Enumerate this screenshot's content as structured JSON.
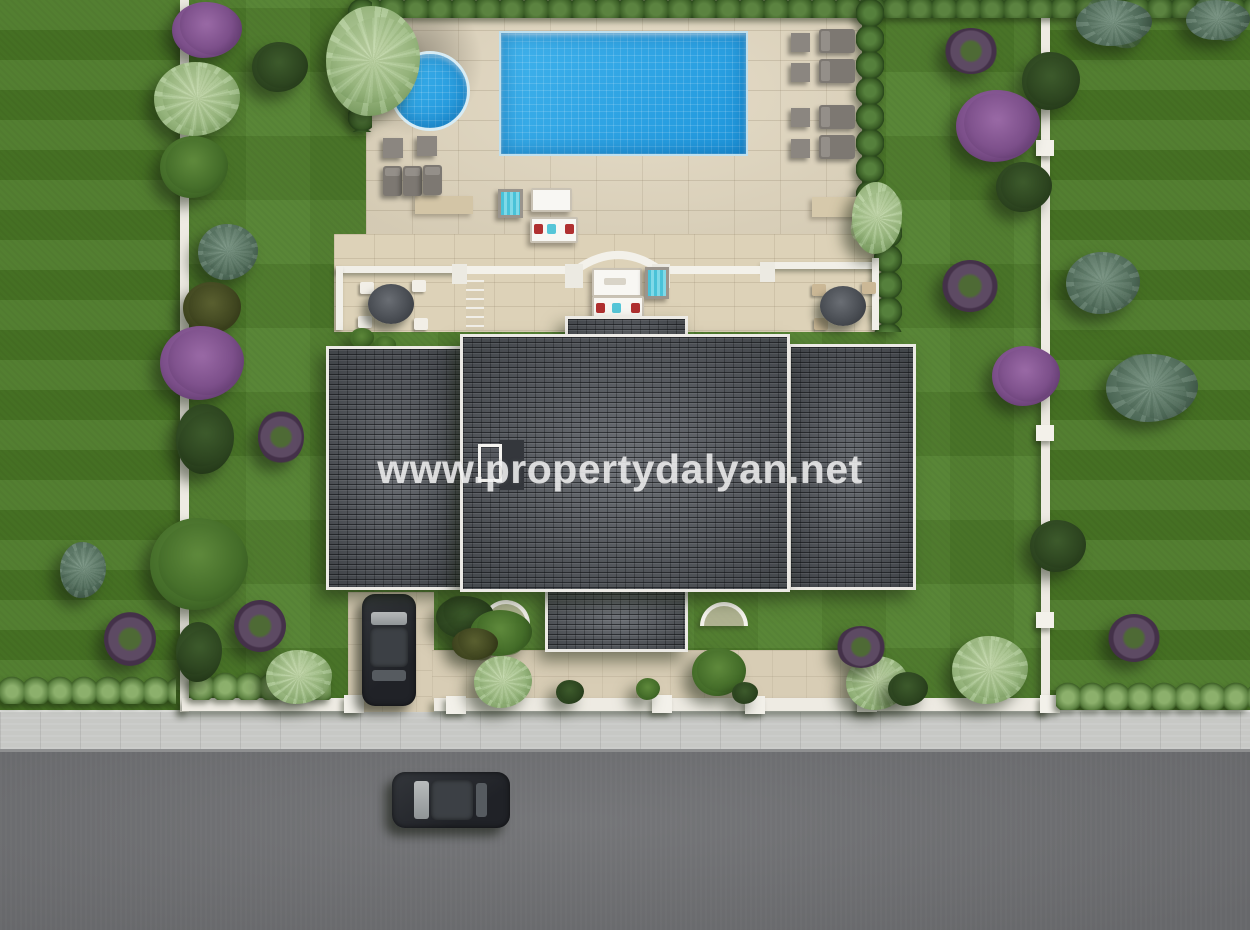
{
  "watermark": {
    "text": "www.propertydalyan.net"
  },
  "scene": {
    "type": "aerial-top-down-3d-render",
    "description": "Top-down 3D architectural render of a detached villa plot: rectangular swimming pool with round plunge pool on a beige paved sun deck, sun loungers with side tables, lower terrace with white balustrade arch, parasol seating, dark grey hipped tile roof, driveway with parked car, landscaped lawns with purple and green trees along white boundary walls, front sidewalk and asphalt road with a passing car.",
    "objects": {
      "main_pool": "rectangular swimming pool",
      "round_pool": "circular plunge pool",
      "sun_loungers": "grey sun loungers with side tables",
      "parasols": "round parasol seating sets",
      "balustrade": "white terrace balustrade with central arch",
      "roof": "dark grey hipped tile roof (left wing, centre block, right wing)",
      "chimney": "white roof hatch and dark vent",
      "driveway_car": "dark car parked on driveway",
      "road_car": "dark car on road",
      "boundary_walls": "white garden walls with posts",
      "hedges": "clipped hedge rows",
      "trees": "purple, green, teal and olive trees and wreath-shaped shrubs"
    },
    "colors": {
      "lawn": "#4f7d2b",
      "neighbor_lawn": "#4a7826",
      "hedge": "#3d6128",
      "paving": "#e2d8c1",
      "terrace": "#ddd2b8",
      "pool_water": "#2da5e8",
      "roof": "#53575d",
      "road": "#6f7073",
      "sidewalk": "#c7c8c5",
      "wall": "#eeebe3",
      "purple_foliage": "#7c4f8a",
      "teal_foliage": "#53705d",
      "car": "#26282c",
      "watermark": "#f8f8f8"
    }
  }
}
